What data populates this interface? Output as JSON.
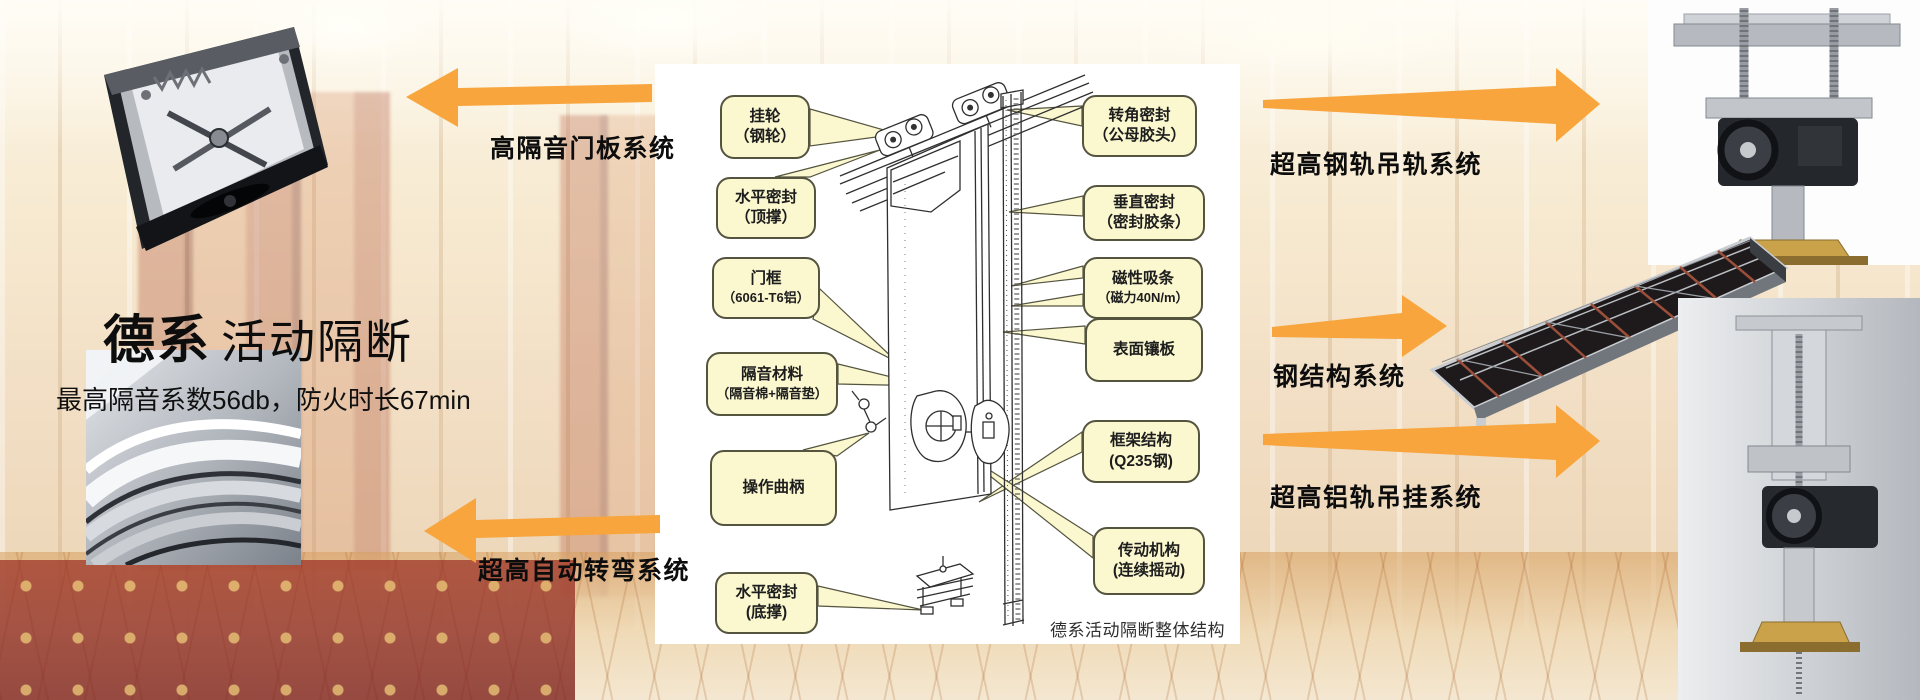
{
  "brand": {
    "title_bold": "德系",
    "title_regular": "活动隔断",
    "subtitle": "最高隔音系数56db，防火时长67min"
  },
  "arrows": {
    "left_top": "高隔音门板系统",
    "left_bottom": "超高自动转弯系统",
    "right_top": "超高钢轨吊轨系统",
    "right_middle": "钢结构系统",
    "right_bottom": "超高铝轨吊挂系统"
  },
  "diagram": {
    "caption": "德系活动隔断整体结构",
    "callouts_left": [
      {
        "line1": "挂轮",
        "line2": "（钢轮）"
      },
      {
        "line1": "水平密封",
        "line2": "（顶撑）"
      },
      {
        "line1": "门框",
        "line2": "（6061-T6铝）"
      },
      {
        "line1": "隔音材料",
        "line2": "（隔音棉+隔音垫）"
      },
      {
        "line1": "操作曲柄"
      },
      {
        "line1": "水平密封",
        "line2": "(底撑)"
      }
    ],
    "callouts_right": [
      {
        "line1": "转角密封",
        "line2": "（公母胶头）"
      },
      {
        "line1": "垂直密封",
        "line2": "（密封胶条）"
      },
      {
        "line1": "磁性吸条",
        "line2": "（磁力40N/m）"
      },
      {
        "line1": "表面镶板"
      },
      {
        "line1": "框架结构",
        "line2": "(Q235钢)"
      },
      {
        "line1": "传动机构",
        "line2": "(连续摇动)"
      }
    ]
  },
  "colors": {
    "arrow_orange": "#F7A53C",
    "callout_fill": "#FBF8D0",
    "callout_border": "#55543F"
  }
}
